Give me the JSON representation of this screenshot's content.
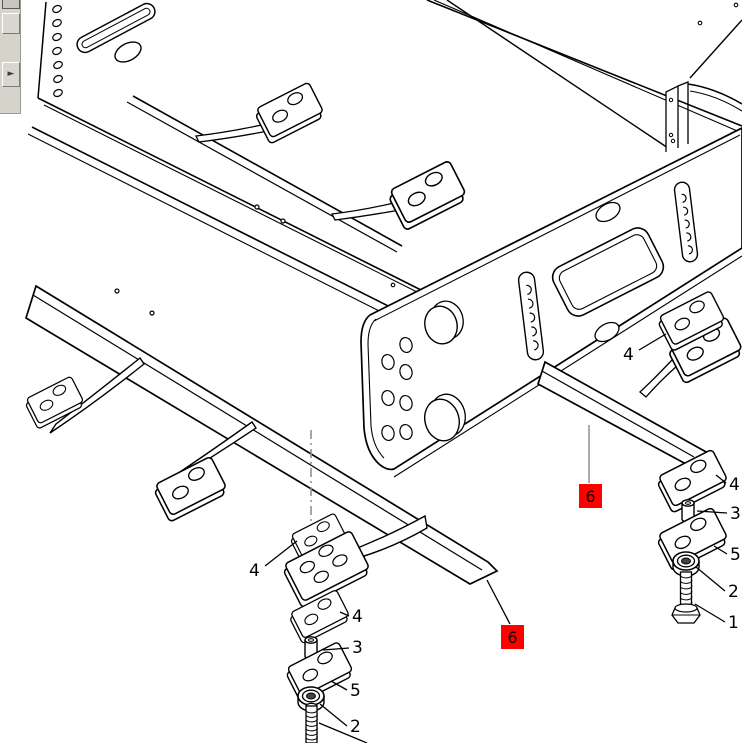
{
  "window": {
    "width": 742,
    "height": 743,
    "background": "#ffffff"
  },
  "toolbar": {
    "buttons": [
      {
        "name": "toolbar-button-partial",
        "glyph": ""
      },
      {
        "name": "toolbar-button-blank",
        "glyph": ""
      },
      {
        "name": "nav-forward-button",
        "glyph": "►"
      }
    ]
  },
  "diagram": {
    "type": "exploded-parts-diagram",
    "subject": "chassis-subframe-mounting-rails",
    "colors": {
      "line": "#000000",
      "leader_gray": "#8f8f8f",
      "marker_bg": "#ff0000",
      "marker_text": "#000000",
      "callout_text": "#000000"
    },
    "callouts": [
      {
        "label": "4",
        "x": 249,
        "y": 576
      },
      {
        "label": "4",
        "x": 352,
        "y": 622
      },
      {
        "label": "3",
        "x": 352,
        "y": 653
      },
      {
        "label": "5",
        "x": 350,
        "y": 696
      },
      {
        "label": "2",
        "x": 350,
        "y": 732
      },
      {
        "label": "4",
        "x": 623,
        "y": 360
      },
      {
        "label": "4",
        "x": 729,
        "y": 490
      },
      {
        "label": "3",
        "x": 730,
        "y": 519
      },
      {
        "label": "5",
        "x": 730,
        "y": 560
      },
      {
        "label": "2",
        "x": 728,
        "y": 597
      },
      {
        "label": "1",
        "x": 728,
        "y": 628
      }
    ],
    "markers": [
      {
        "label": "6",
        "x": 579,
        "y": 484,
        "w": 23,
        "h": 24
      },
      {
        "label": "6",
        "x": 501,
        "y": 625,
        "w": 23,
        "h": 24
      }
    ]
  }
}
